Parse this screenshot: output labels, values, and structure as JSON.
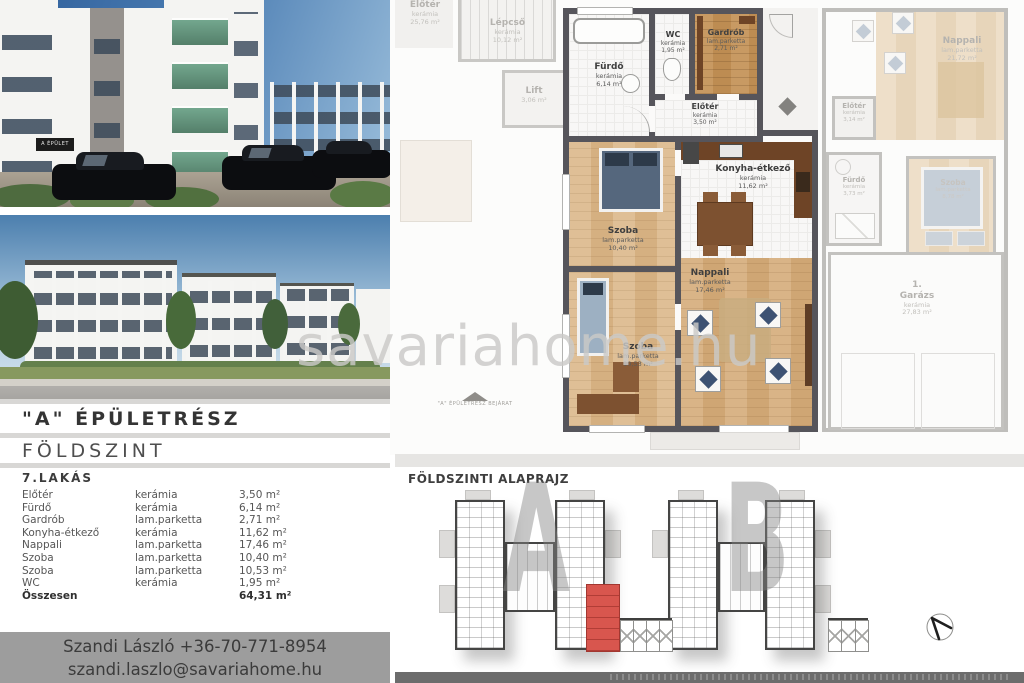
{
  "watermark": "savariahome.hu",
  "photo_top": {
    "sign": "A ÉPÜLET"
  },
  "info_panel": {
    "section_title": "\"A\" ÉPÜLETRÉSZ",
    "floor_title": "FÖLDSZINT",
    "unit_title": "7.LAKÁS",
    "rows": [
      {
        "name": "Előtér",
        "material": "kerámia",
        "area": "3,50 m²"
      },
      {
        "name": "Fürdő",
        "material": "kerámia",
        "area": "6,14 m²"
      },
      {
        "name": "Gardrób",
        "material": "lam.parketta",
        "area": "2,71 m²"
      },
      {
        "name": "Konyha-étkező",
        "material": "kerámia",
        "area": "11,62 m²"
      },
      {
        "name": "Nappali",
        "material": "lam.parketta",
        "area": "17,46 m²"
      },
      {
        "name": "Szoba",
        "material": "lam.parketta",
        "area": "10,40 m²"
      },
      {
        "name": "Szoba",
        "material": "lam.parketta",
        "area": "10,53 m²"
      },
      {
        "name": "WC",
        "material": "kerámia",
        "area": "1,95 m²"
      }
    ],
    "total": {
      "label": "Összesen",
      "area": "64,31 m²"
    }
  },
  "contact": {
    "line1": "Szandi László +36-70-771-8954",
    "line2": "szandi.laszlo@savariahome.hu"
  },
  "floor_plan": {
    "entrance_label": "\"A\" ÉPÜLETRÉSZ BEJÁRAT",
    "rooms": {
      "furdo": {
        "name": "Fürdő",
        "material": "kerámia",
        "area": "6,14 m²"
      },
      "wc": {
        "name": "WC",
        "material": "kerámia",
        "area": "1,95 m²"
      },
      "gardrob": {
        "name": "Gardrób",
        "material": "lam.parketta",
        "area": "2,71 m²"
      },
      "eloter": {
        "name": "Előtér",
        "material": "kerámia",
        "area": "3,50 m²"
      },
      "szoba1": {
        "name": "Szoba",
        "material": "lam.parketta",
        "area": "10,40 m²"
      },
      "konyha": {
        "name": "Konyha-étkező",
        "material": "kerámia",
        "area": "11,62 m²"
      },
      "nappali": {
        "name": "Nappali",
        "material": "lam.parketta",
        "area": "17,46 m²"
      },
      "szoba2": {
        "name": "Szoba",
        "material": "lam.parketta",
        "area": "10,53 m²"
      }
    },
    "faded": {
      "eloter_kozos": {
        "name": "Előtér",
        "material": "kerámia",
        "area": "25,76 m²"
      },
      "lepcso": {
        "name": "Lépcső",
        "material": "kerámia",
        "area": "10,12 m²"
      },
      "lift": {
        "name": "Lift",
        "area": "3,06 m²"
      },
      "nappali_b": {
        "name": "Nappali",
        "material": "lam.parketta",
        "area": "21,72 m²"
      },
      "eloter_b": {
        "name": "Előtér",
        "material": "kerámia",
        "area": "3,14 m²"
      },
      "furdo_b": {
        "name": "Fürdő",
        "material": "kerámia",
        "area": "3,73 m²"
      },
      "szoba_b": {
        "name": "Szoba",
        "material": "lam.parketta",
        "area": "8,78 m²"
      },
      "garazs": {
        "num": "1.",
        "name": "Garázs",
        "material": "kerámia",
        "area": "27,83 m²"
      }
    }
  },
  "site_plan": {
    "title": "FÖLDSZINTI ALAPRAJZ",
    "building_a": "A",
    "building_b": "B"
  },
  "colors": {
    "accent_red": "#d8564e",
    "wall_dark": "#56555b",
    "contact_bg": "#9d9d9d"
  }
}
